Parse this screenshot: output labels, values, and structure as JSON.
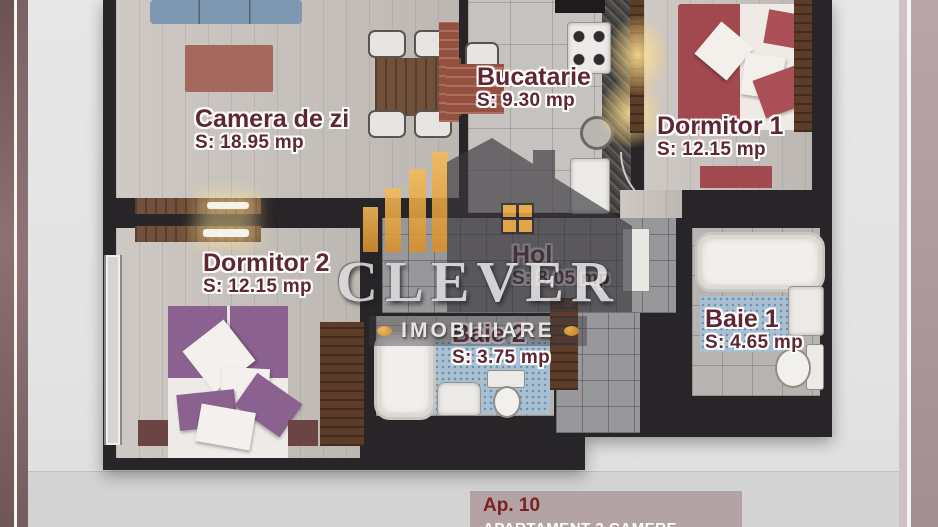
{
  "plan": {
    "rooms": [
      {
        "id": "camera-de-zi",
        "name": "Camera de zi",
        "area": "S: 18.95 mp"
      },
      {
        "id": "bucatarie",
        "name": "Bucatarie",
        "area": "S: 9.30 mp"
      },
      {
        "id": "dormitor-1",
        "name": "Dormitor 1",
        "area": "S: 12.15 mp"
      },
      {
        "id": "dormitor-2",
        "name": "Dormitor 2",
        "area": "S: 12.15 mp"
      },
      {
        "id": "hol",
        "name": "Hol",
        "area": "S: 8.05 mp"
      },
      {
        "id": "baie-2",
        "name": "Baie 2",
        "area": "S: 3.75 mp"
      },
      {
        "id": "baie-1",
        "name": "Baie 1",
        "area": "S: 4.65 mp"
      }
    ]
  },
  "branding": {
    "logo_text": "CLEVER",
    "logo_subtext": "IMOBILIARE",
    "accent_orange": "#eda83f",
    "label_maroon": "#5e2733"
  },
  "footer": {
    "apartment_label": "Ap. 10",
    "apartment_subtitle": "APARTAMENT 3 CAMERE"
  }
}
